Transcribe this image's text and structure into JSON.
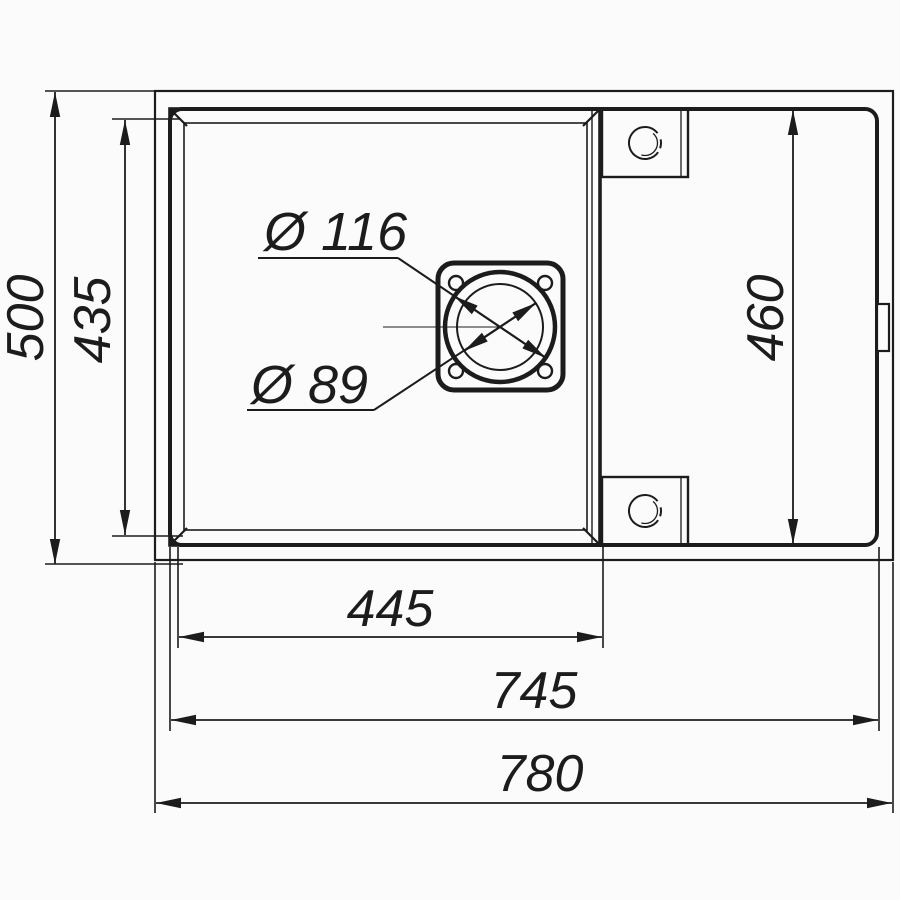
{
  "drawing": {
    "type": "sink-dimension-drawing",
    "colors": {
      "line": "#1c1c1c",
      "background": "#fbfbfb"
    },
    "dims": {
      "outer_height": "500",
      "bowl_height": "435",
      "rim_height": "460",
      "bowl_width": "445",
      "rim_width": "745",
      "outer_width": "780"
    },
    "drain": {
      "outer_diameter_label": "Ø 116",
      "inner_diameter_label": "Ø 89"
    }
  }
}
